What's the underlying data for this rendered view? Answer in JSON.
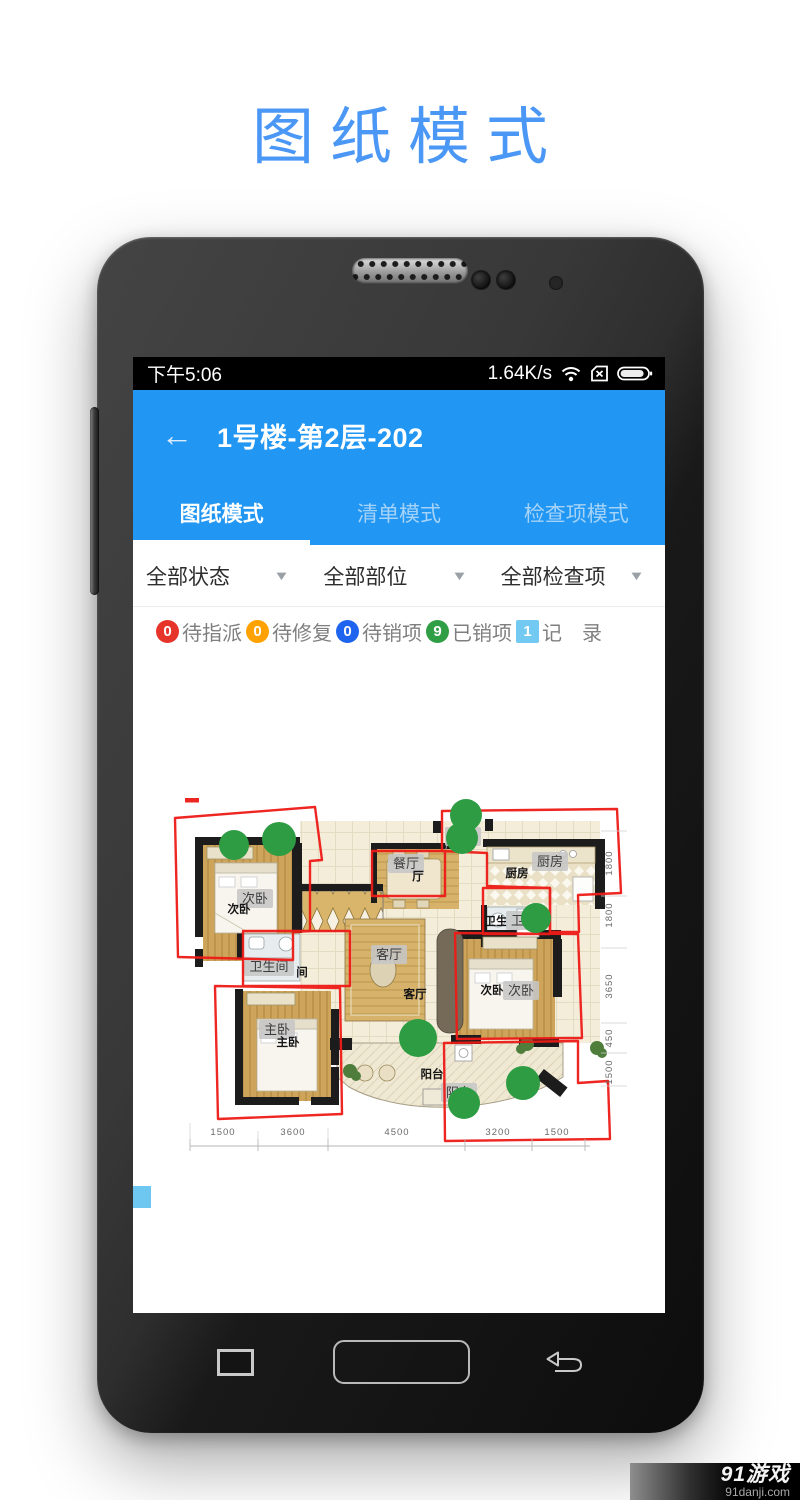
{
  "page": {
    "title": "图纸模式",
    "title_color": "#4a97f5"
  },
  "status_bar": {
    "time": "下午5:06",
    "net_speed": "1.64K/s",
    "icons": [
      "wifi-icon",
      "no-sim-icon",
      "battery-icon"
    ]
  },
  "app_header": {
    "back_glyph": "←",
    "title": "1号楼-第2层-202",
    "bg_color": "#2196f3"
  },
  "tabs": [
    {
      "label": "图纸模式",
      "active": true
    },
    {
      "label": "清单模式",
      "active": false
    },
    {
      "label": "检查项模式",
      "active": false
    }
  ],
  "filters": [
    {
      "label": "全部状态"
    },
    {
      "label": "全部部位"
    },
    {
      "label": "全部检查项"
    }
  ],
  "legend": [
    {
      "count": "0",
      "label": "待指派",
      "color": "#e6342a"
    },
    {
      "count": "0",
      "label": "待修复",
      "color": "#ffa200"
    },
    {
      "count": "0",
      "label": "待销项",
      "color": "#1f64ee"
    },
    {
      "count": "9",
      "label": "已销项",
      "color": "#2f9e44"
    },
    {
      "count": "1",
      "label": "记　录",
      "color": "#72c9f1"
    }
  ],
  "floorplan": {
    "labels": [
      "次卧",
      "次卧",
      "卫生间",
      "间",
      "主卧",
      "主卧",
      "餐厅",
      "厅",
      "入门",
      "厨房",
      "厨房",
      "卫生",
      "卫生",
      "客厅",
      "客厅",
      "次卧",
      "次卧",
      "阳台",
      "阳台"
    ],
    "dims_bottom": [
      "1500",
      "3600",
      "4500",
      "3200",
      "1500"
    ],
    "dims_right": [
      "1800",
      "1800",
      "3650",
      "450",
      "1500"
    ],
    "marker_color": "#2f9e44",
    "outline_color": "#ee1b17"
  },
  "nav_icons": [
    "recents-icon",
    "home-icon",
    "back-icon"
  ],
  "watermark": {
    "brand": "91游戏",
    "site": "91danji.com"
  }
}
